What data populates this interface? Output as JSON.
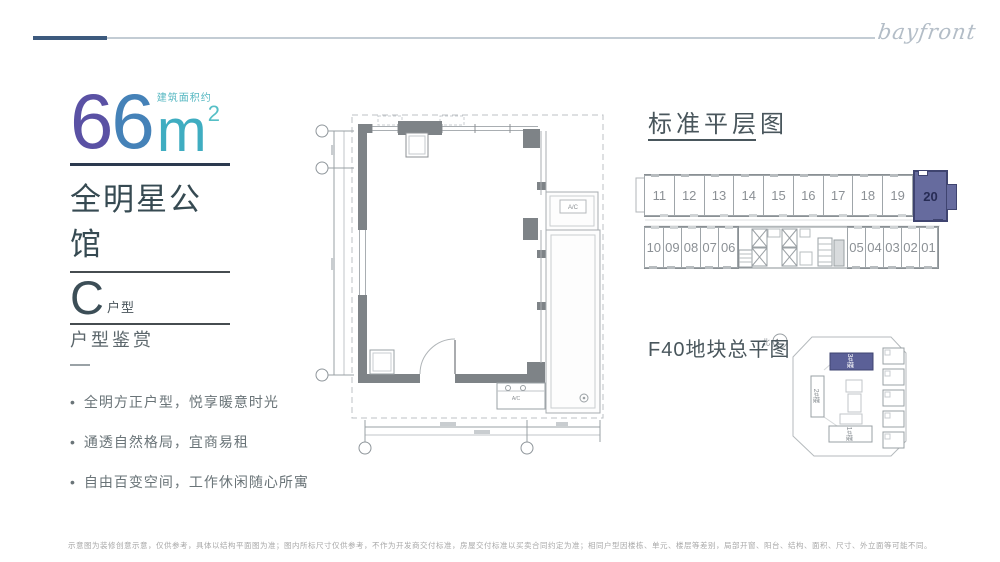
{
  "brand": {
    "logo_text": "bayfront"
  },
  "unit_info": {
    "area_label": "建筑面积约",
    "area_digit_1": "6",
    "area_digit_2": "6",
    "area_unit": "m",
    "area_sup": "2",
    "estate_name": "全明星公馆",
    "type_letter": "C",
    "type_suffix": "户型"
  },
  "appreciation": {
    "heading": "户型鉴赏",
    "bullets": [
      "全明方正户型，悦享暖意时光",
      "通透自然格局，宜商易租",
      "自由百变空间，工作休闲随心所寓"
    ]
  },
  "floorplate": {
    "heading": "标准平层图",
    "top_units": [
      "11",
      "12",
      "13",
      "14",
      "15",
      "16",
      "17",
      "18",
      "19"
    ],
    "highlight_unit": "20",
    "bottom_left_units": [
      "10",
      "09",
      "08",
      "07",
      "06"
    ],
    "bottom_right_units": [
      "05",
      "04",
      "03",
      "02",
      "01"
    ],
    "highlight_fill": "#666b9e",
    "highlight_border": "#3f4470"
  },
  "siteplan": {
    "heading": "F40地块总平图",
    "north_label": "北",
    "buildings": [
      {
        "label": "3#楼",
        "highlighted": true
      },
      {
        "label": "2#楼",
        "highlighted": false
      },
      {
        "label": "1#楼",
        "highlighted": false
      }
    ]
  },
  "plan": {
    "ac_upper": "A/C",
    "ac_lower": "A/C"
  },
  "colors": {
    "accent_purple": "#5a51a4",
    "accent_blue": "#4582b8",
    "accent_teal": "#3fadc1",
    "rule_navy": "#2c3a4f",
    "header_line_dark": "#3d5a7e",
    "header_line_light": "#c3ccd4"
  },
  "disclaimer": "示意图为装修创意示意，仅供参考，具体以结构平面图为准；图内所标尺寸仅供参考，不作为开发商交付标准，房屋交付标准以买卖合同约定为准；相同户型因楼栋、单元、楼层等差别，局部开窗、阳台、结构、面积、尺寸、外立面等可能不同。"
}
